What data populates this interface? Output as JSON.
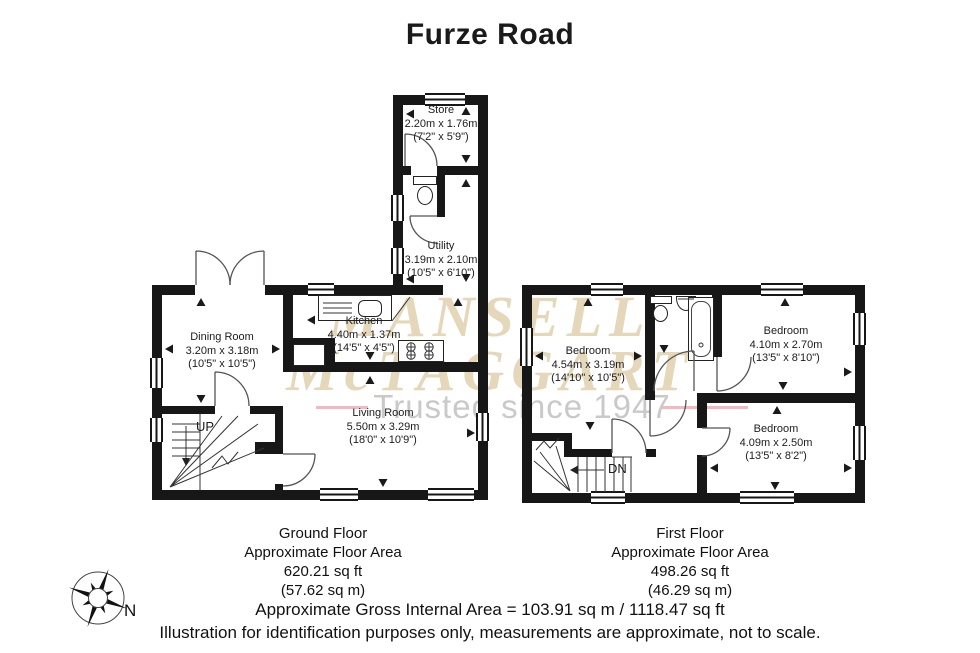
{
  "title": "Furze Road",
  "watermark": {
    "line1": "MANSELL",
    "line2": "McTAGGART",
    "tagline": "Trusted since 1947",
    "gold_color": "#ccb076",
    "gray_color": "#c9c9c9",
    "pink_color": "#f3b8c2"
  },
  "ground_floor": {
    "stairs_label": "UP",
    "rooms": {
      "store": {
        "name": "Store",
        "metric": "2.20m x 1.76m",
        "imperial": "(7'2\" x 5'9\")"
      },
      "utility": {
        "name": "Utility",
        "metric": "3.19m x 2.10m",
        "imperial": "(10'5\" x 6'10\")"
      },
      "kitchen": {
        "name": "Kitchen",
        "metric": "4.40m x 1.37m",
        "imperial": "(14'5\" x 4'5\")"
      },
      "dining": {
        "name": "Dining Room",
        "metric": "3.20m x 3.18m",
        "imperial": "(10'5\" x 10'5\")"
      },
      "living": {
        "name": "Living Room",
        "metric": "5.50m x 3.29m",
        "imperial": "(18'0\" x 10'9\")"
      }
    },
    "caption": [
      "Ground Floor",
      "Approximate Floor Area",
      "620.21 sq ft",
      "(57.62 sq m)"
    ]
  },
  "first_floor": {
    "stairs_label": "DN",
    "rooms": {
      "bedroom1": {
        "name": "Bedroom",
        "metric": "4.54m x 3.19m",
        "imperial": "(14'10\" x 10'5\")"
      },
      "bedroom2": {
        "name": "Bedroom",
        "metric": "4.10m x 2.70m",
        "imperial": "(13'5\" x 8'10\")"
      },
      "bedroom3": {
        "name": "Bedroom",
        "metric": "4.09m x 2.50m",
        "imperial": "(13'5\" x 8'2\")"
      }
    },
    "caption": [
      "First Floor",
      "Approximate Floor Area",
      "498.26 sq ft",
      "(46.29 sq m)"
    ]
  },
  "compass": {
    "label": "N"
  },
  "footer": {
    "line1": "Approximate Gross Internal Area  = 103.91 sq m / 1118.47 sq ft",
    "line2": "Illustration for identification purposes only, measurements are approximate, not to scale."
  },
  "colors": {
    "wall": "#171717"
  }
}
